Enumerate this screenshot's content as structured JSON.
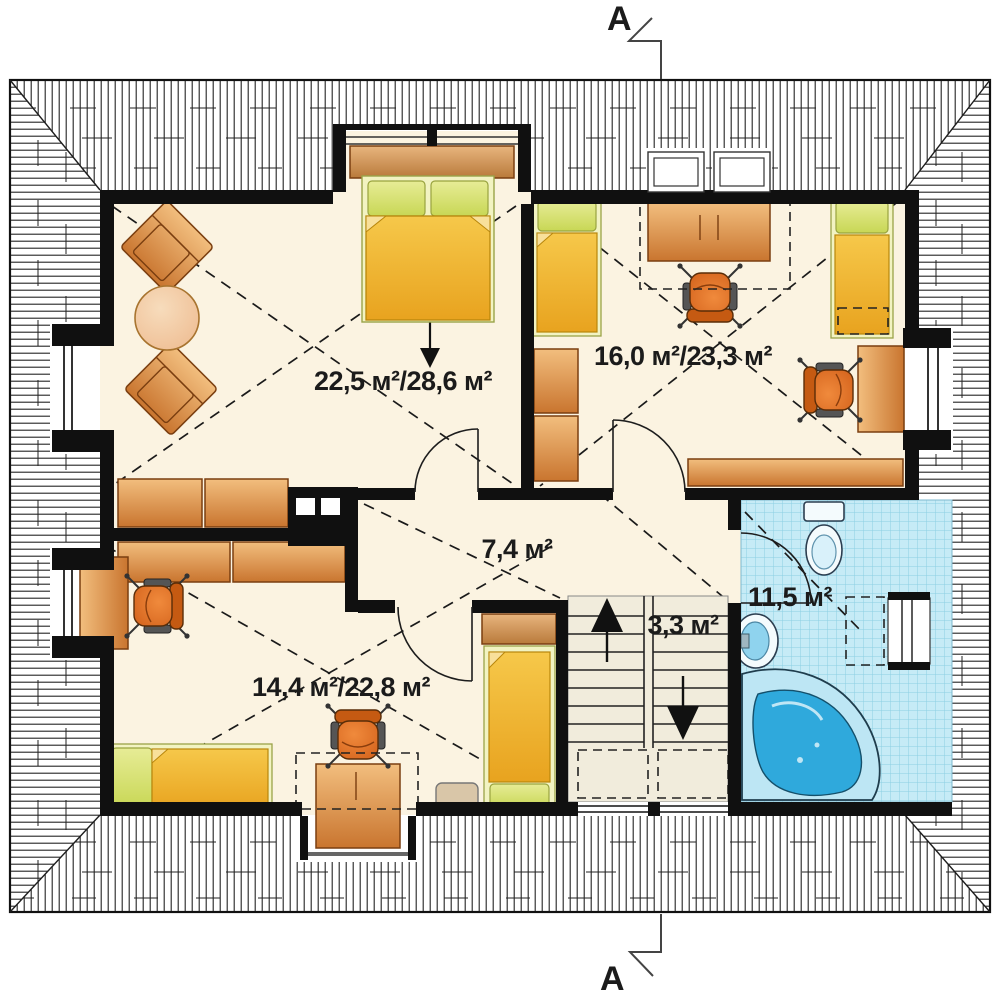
{
  "plan": {
    "title": "Attic floor plan",
    "section_marker_top": "A",
    "section_marker_bottom": "A",
    "rooms": [
      {
        "name": "bedroom-top-left",
        "area_label": "22,5 м²/28,6 м²"
      },
      {
        "name": "bedroom-top-right",
        "area_label": "16,0 м²/23,3 м²"
      },
      {
        "name": "hall",
        "area_label": "7,4 м²"
      },
      {
        "name": "staircase",
        "area_label": "3,3 м²"
      },
      {
        "name": "bathroom",
        "area_label": "11,5 м²"
      },
      {
        "name": "bedroom-bottom-left",
        "area_label": "14,4 м²/22,8 м²"
      }
    ],
    "colors": {
      "floor": "#FBF3E1",
      "wall": "#101010",
      "wood_light": "#F2BE7E",
      "wood_dark": "#C9752F",
      "bed_blanket": "#F2B32C",
      "bed_pillow": "#DCE27A",
      "bed_frame": "#F2F3C2",
      "tile": "#C6EBF6",
      "tile_line": "#8CCFE3",
      "water": "#2FA9DC",
      "chair": "#E2701C"
    }
  }
}
